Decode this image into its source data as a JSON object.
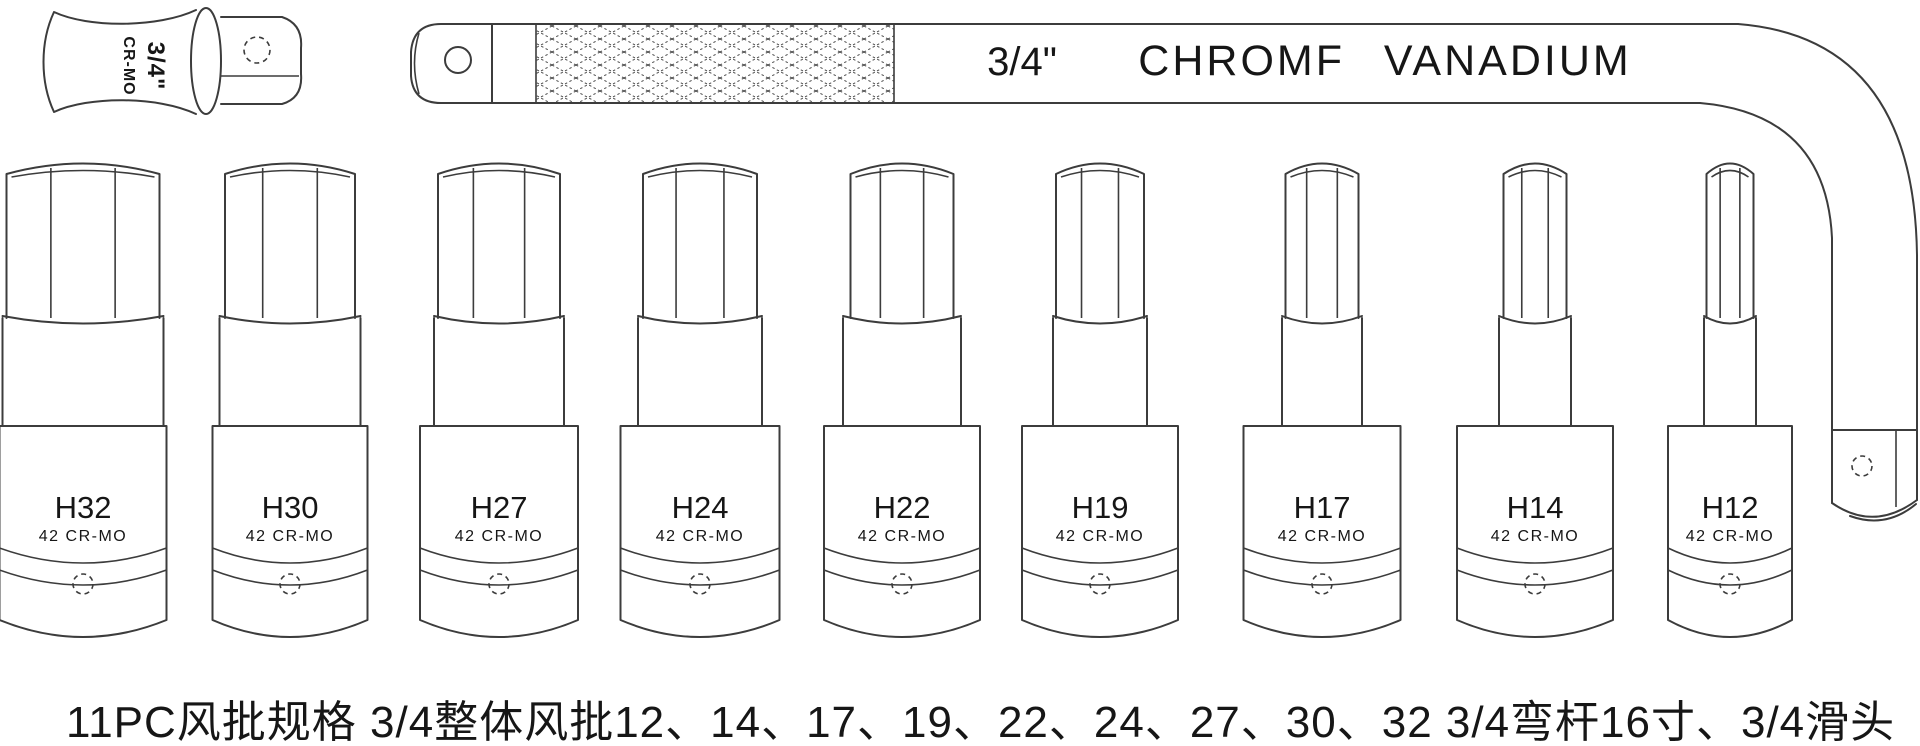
{
  "page": {
    "background": "#ffffff",
    "line_color": "#3c3c3c",
    "text_color": "#161616"
  },
  "slide_head": {
    "size_label": "3/4\"",
    "material_label": "CR-MO"
  },
  "breaker_bar": {
    "size_label": "3/4\"",
    "material_label": "CHROMF VANADIUM"
  },
  "sockets": {
    "items": [
      {
        "label": "H32",
        "material": "42 CR-MO",
        "cx": 83,
        "hex_w": 153,
        "cyl_w": 161,
        "body_w": 167
      },
      {
        "label": "H30",
        "material": "42 CR-MO",
        "cx": 290,
        "hex_w": 130,
        "cyl_w": 141,
        "body_w": 155
      },
      {
        "label": "H27",
        "material": "42 CR-MO",
        "cx": 499,
        "hex_w": 122,
        "cyl_w": 130,
        "body_w": 158
      },
      {
        "label": "H24",
        "material": "42 CR-MO",
        "cx": 700,
        "hex_w": 114,
        "cyl_w": 124,
        "body_w": 159
      },
      {
        "label": "H22",
        "material": "42 CR-MO",
        "cx": 902,
        "hex_w": 103,
        "cyl_w": 118,
        "body_w": 156
      },
      {
        "label": "H19",
        "material": "42 CR-MO",
        "cx": 1100,
        "hex_w": 88,
        "cyl_w": 94,
        "body_w": 156
      },
      {
        "label": "H17",
        "material": "42 CR-MO",
        "cx": 1322,
        "hex_w": 73,
        "cyl_w": 80,
        "body_w": 157
      },
      {
        "label": "H14",
        "material": "42 CR-MO",
        "cx": 1535,
        "hex_w": 63,
        "cyl_w": 72,
        "body_w": 156
      },
      {
        "label": "H12",
        "material": "42 CR-MO",
        "cx": 1730,
        "hex_w": 47,
        "cyl_w": 52,
        "body_w": 124
      }
    ]
  },
  "caption": {
    "text": "11PC风批规格  3/4整体风批12、14、17、19、22、24、27、30、32 3/4弯杆16寸、3/4滑头"
  }
}
